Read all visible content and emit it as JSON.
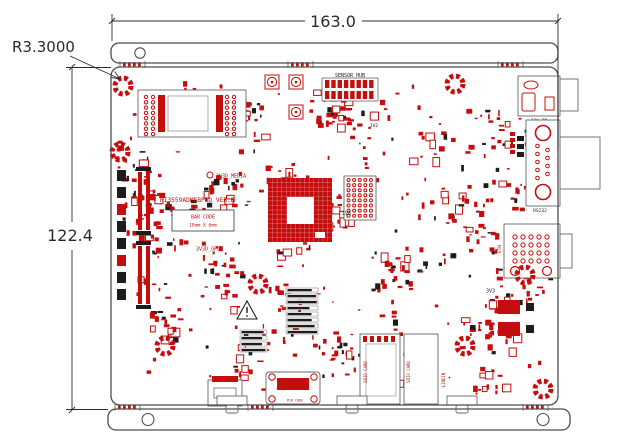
{
  "annotations": {
    "width_label": "163.0",
    "height_label": "122.4",
    "corner_radius_label": "R3.3000"
  },
  "silkscreen": {
    "title": "HI3559ADMEBPRO VER.B",
    "barcode_line1": "BAR CODE",
    "barcode_line2": "18mm X 6mm",
    "sensor_hub_label": "SENSOR HUB",
    "power_in_label": "12V_IN",
    "rs232_label": "RS232",
    "eth_label": "ETH",
    "media_rail_label": "3V3D_MEDIA",
    "gpu_rail_label": "3V3D_GPU",
    "rail_1v8_label": "1V8",
    "rail_1v2_label": "1V2",
    "rail_3v3_label": "3V3",
    "pcb_code_label": "PCB CODE",
    "sd_card1_label": "SDIO CARD",
    "sd_card2_label": "SDIO CARD",
    "line_in_label": "LINEIN"
  },
  "colors": {
    "silkscreen_red": "#c60d0d",
    "silkscreen_black": "#1c1c1c",
    "outline_gray": "#4d4d4d"
  }
}
